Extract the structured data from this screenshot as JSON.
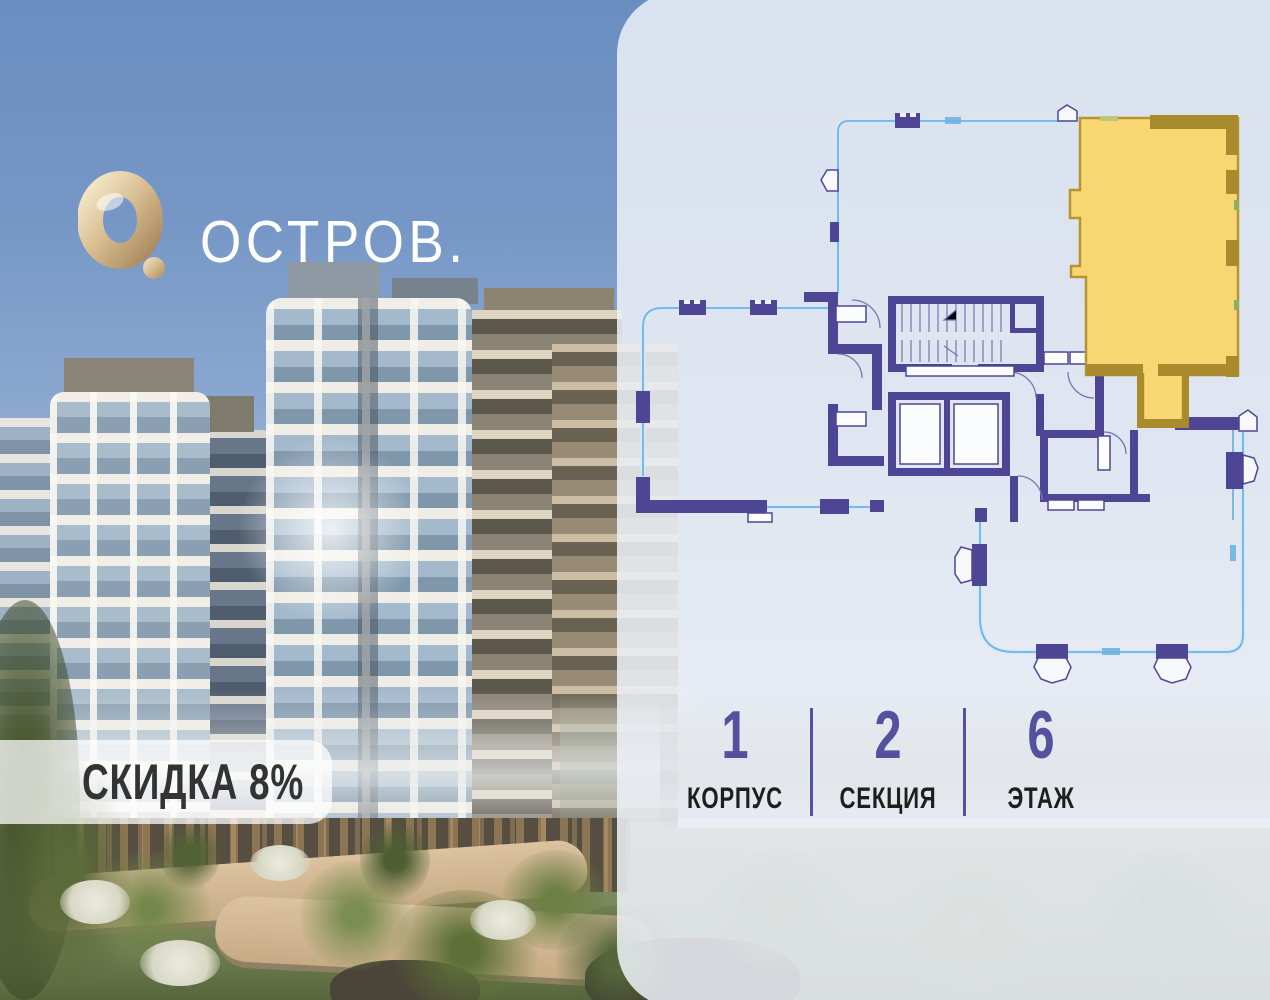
{
  "brand": {
    "logo_text": "ОСТРОВ.",
    "logo_mark": "gold-ring-with-dot"
  },
  "discount": {
    "text": "СКИДКА 8%"
  },
  "apartment_info": {
    "items": [
      {
        "value": "1",
        "label": "КОРПУС"
      },
      {
        "value": "2",
        "label": "СЕКЦИЯ"
      },
      {
        "value": "6",
        "label": "ЭТАЖ"
      }
    ]
  },
  "floor_plan": {
    "highlighted_unit_fill": "#f8d772",
    "highlighted_unit_border": "#a98b2e",
    "wall_color": "#4e4695",
    "terrace_line_color": "#6fb4e4"
  },
  "colors": {
    "info_number": "#57509e",
    "info_divider": "#57509e",
    "info_label": "#1e1e1e",
    "panel_bg": "rgba(236,239,246,0.87)",
    "badge_bg": "rgba(253,253,253,0.74)",
    "badge_text": "#333333",
    "sky_top": "#6a8ec0"
  }
}
